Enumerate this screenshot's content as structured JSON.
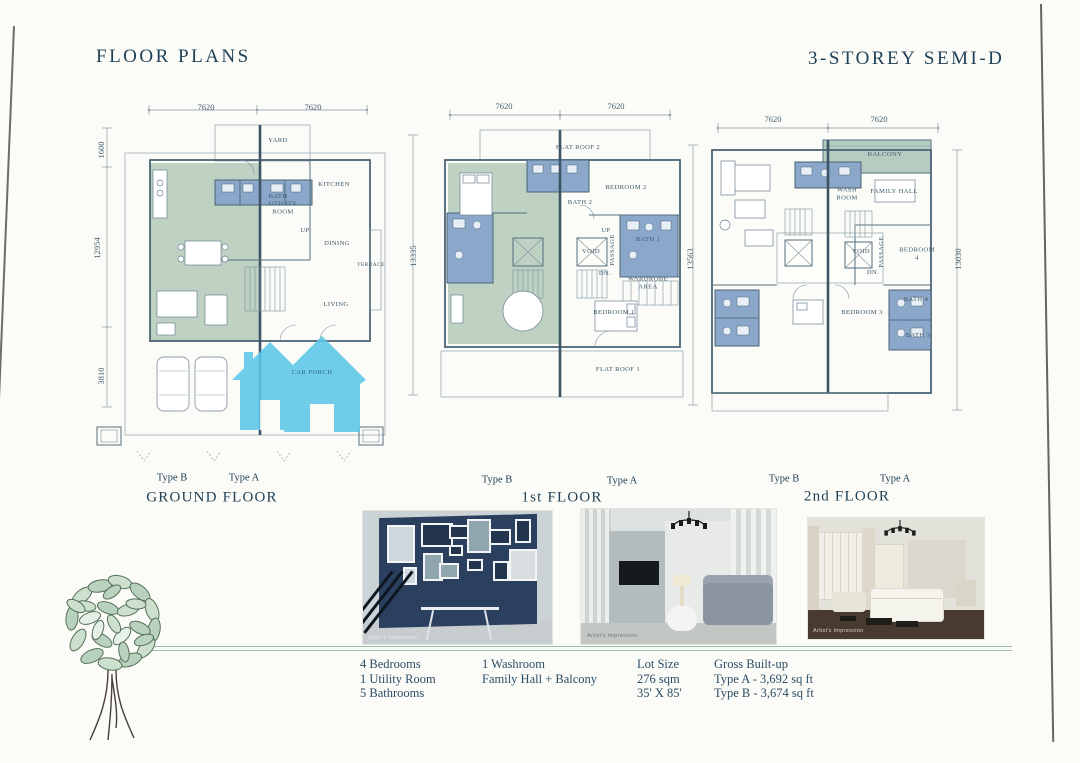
{
  "page": {
    "title_left": "FLOOR PLANS",
    "title_right": "3-STOREY SEMI-D"
  },
  "plans": [
    {
      "name": "GROUND FLOOR",
      "type_left": "Type B",
      "type_right": "Type A",
      "dims_top": [
        "7620",
        "7620"
      ],
      "dims_left": [
        "1600",
        "12954",
        "3810"
      ],
      "rooms": [
        "YARD",
        "BATH",
        "KITCHEN",
        "UTILITY ROOM",
        "UP",
        "DINING",
        "TERRACE",
        "LIVING",
        "CAR PORCH"
      ]
    },
    {
      "name": "1st FLOOR",
      "type_left": "Type B",
      "type_right": "Type A",
      "dims_top": [
        "7620",
        "7620"
      ],
      "dims_left": [
        "13335"
      ],
      "dims_right": [
        "13563"
      ],
      "rooms": [
        "FLAT ROOF 2",
        "BEDROOM 2",
        "BATH 2",
        "UP",
        "PASSAGE",
        "VOID",
        "DN.",
        "BATH 1",
        "WARDROBE AREA",
        "BEDROOM 1",
        "FLAT ROOF 1"
      ]
    },
    {
      "name": "2nd FLOOR",
      "type_left": "Type B",
      "type_right": "Type A",
      "dims_top": [
        "7620",
        "7620"
      ],
      "dims_right": [
        "13030"
      ],
      "rooms": [
        "BALCONY",
        "WASH ROOM",
        "FAMILY HALL",
        "VOID",
        "PASSAGE",
        "BEDROOM 4",
        "DN.",
        "BEDROOM 3",
        "BATH 4",
        "BATH 3"
      ]
    }
  ],
  "photos": [
    {
      "caption": "Artist's Impression",
      "subject": "gallery wall with framed pictures"
    },
    {
      "caption": "Artist's Impression",
      "subject": "living hall with chandelier and sofa"
    },
    {
      "caption": "Artist's Impression",
      "subject": "bedroom with chandelier and bed"
    }
  ],
  "specs": {
    "columns": [
      {
        "lines": [
          "4 Bedrooms",
          "1 Utility Room",
          "5 Bathrooms"
        ]
      },
      {
        "lines": [
          "1 Washroom",
          "Family Hall + Balcony"
        ]
      },
      {
        "lines": [
          "Lot Size",
          "276 sqm",
          "35' X 85'"
        ]
      },
      {
        "lines": [
          "Gross Built-up",
          "Type A - 3,692 sq ft",
          "Type B - 3,674 sq ft"
        ]
      }
    ]
  },
  "colors": {
    "accent_logo_blue": "#5cc7e9",
    "plan_green": "#bed1c3",
    "plan_green_2nd": "#b6ccc1",
    "plan_bath_blue": "#8ba7c9",
    "ink": "#1e3f55"
  }
}
